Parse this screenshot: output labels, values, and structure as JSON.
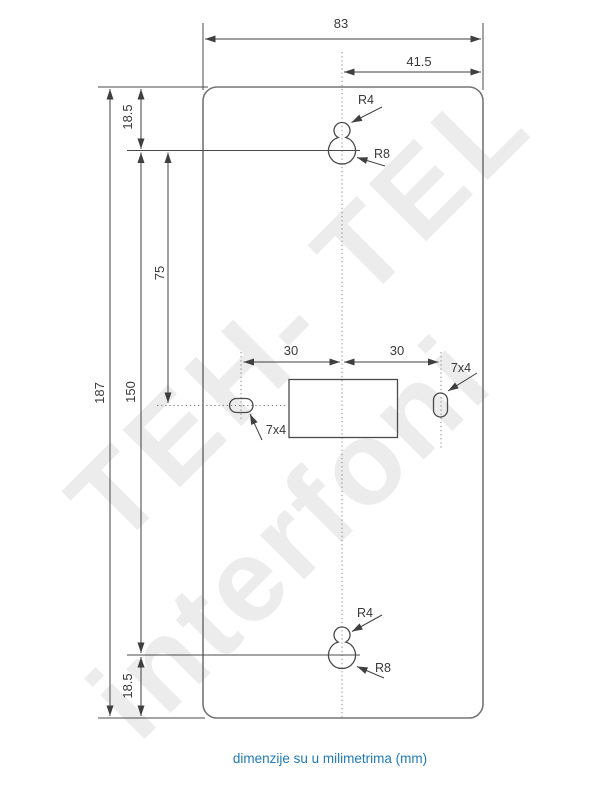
{
  "caption": "dimenzije su u milimetrima (mm)",
  "watermark": {
    "line1": "TEH- TEL",
    "line2": "interfoni"
  },
  "labels": {
    "overall_width": "83",
    "center_to_right_edge": "41.5",
    "top_keyhole_offset": "18.5",
    "keyhole_spacing": "150",
    "keyhole_to_slot_row": "75",
    "overall_height": "187",
    "bottom_keyhole_offset": "18.5",
    "left_slot_to_center": "30",
    "center_to_right_slot": "30",
    "left_slot_size": "7x4",
    "right_slot_size": "7x4",
    "top_keyhole_small_radius": "R4",
    "top_keyhole_large_radius": "R8",
    "bottom_keyhole_small_radius": "R4",
    "bottom_keyhole_large_radius": "R8"
  },
  "colors": {
    "dimension_lines": "#3f3f3f",
    "plate_outline": "#757575",
    "caption_text": "#1f7ab9",
    "watermark": "#ececec"
  }
}
